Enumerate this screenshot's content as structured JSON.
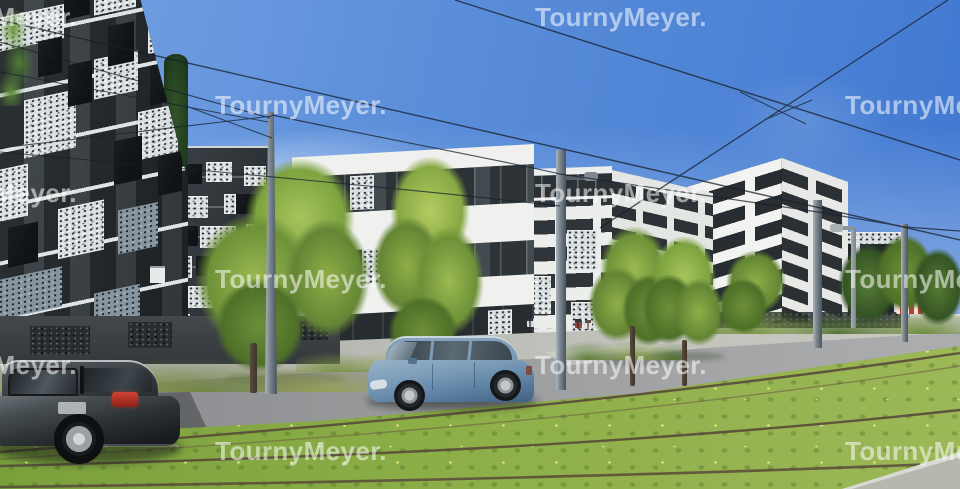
{
  "image_type": "architectural rendering photograph, street scene with tram tracks",
  "watermark": {
    "text": "TournyMeyer.",
    "color": "#ffffff",
    "opacity": 0.55,
    "positions": [
      [
        -95,
        4
      ],
      [
        535,
        4
      ],
      [
        215,
        92
      ],
      [
        845,
        92
      ],
      [
        -95,
        180
      ],
      [
        535,
        180
      ],
      [
        215,
        266
      ],
      [
        845,
        266
      ],
      [
        -95,
        352
      ],
      [
        535,
        352
      ],
      [
        215,
        438
      ],
      [
        845,
        438
      ]
    ]
  },
  "scene": {
    "sky": {
      "top_color": "#4a80d4",
      "horizon_color": "#b9cff0",
      "clouds": "faint wisps"
    },
    "palette": {
      "facade_dark": "#2f3538",
      "facade_white": "#eeefed",
      "lace_panel": "#dadfe1",
      "grass": "#85a744",
      "road": "#9b9c9e",
      "sidewalk": "#bcbdb7",
      "tree_green": "#8fae48",
      "car_dark_gray": "#2c3134",
      "car_steel_blue": "#7091ad",
      "taillight_red": "#b5362a",
      "rail_brown": "#584a3a",
      "kiosk_red": "#b8402e"
    },
    "objects": {
      "buildings": [
        "left dark residential block with white perforated lace panels",
        "second dark lace-panel wing",
        "center white block with dark window strips",
        "center-right white block with lace patches and penthouse",
        "right white block with staggered dark windows",
        "far-right low lace-facade building"
      ],
      "vehicles": [
        "dark gray station wagon parked left",
        "steel blue MPV parked center"
      ],
      "people": [
        "pedestrian near entrance",
        "two pedestrians walking together"
      ],
      "infrastructure": [
        "tram catenary poles",
        "overhead wires",
        "street lamp",
        "grass tram track with rails",
        "road",
        "sidewalk",
        "gabion wall",
        "red-white kiosk awning"
      ],
      "vegetation": [
        "street trees",
        "cypress",
        "hedges",
        "dry grass mound",
        "balcony plants"
      ]
    }
  }
}
